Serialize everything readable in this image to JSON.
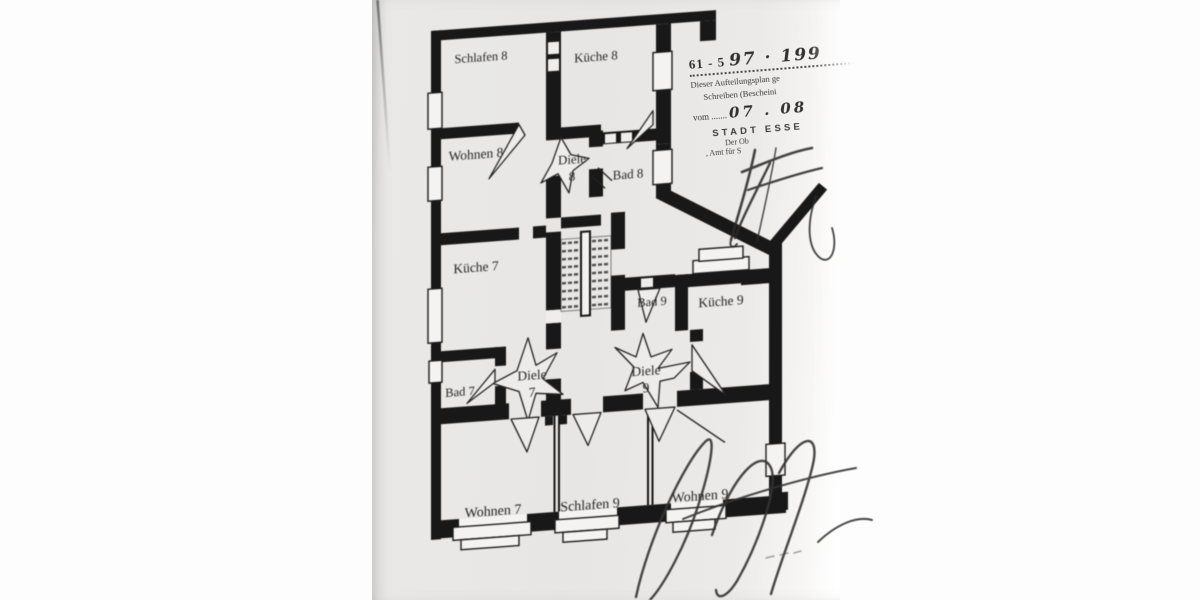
{
  "document": {
    "kind": "scanned floor plan (Aufteilungsplan)",
    "colors": {
      "paper": "#e8e7e5",
      "wall_ink": "#181818",
      "stamp_ink": "#3a3a3a",
      "margin": "#ffffff"
    }
  },
  "rooms": [
    {
      "id": "schlafen-8",
      "name": "Schlafen 8"
    },
    {
      "id": "kueche-8",
      "name": "Küche 8"
    },
    {
      "id": "wohnen-8",
      "name": "Wohnen 8"
    },
    {
      "id": "diele-8",
      "name": "Diele",
      "num": "8"
    },
    {
      "id": "bad-8",
      "name": "Bad 8"
    },
    {
      "id": "kueche-7",
      "name": "Küche 7"
    },
    {
      "id": "bad-9",
      "name": "Bad 9"
    },
    {
      "id": "kueche-9",
      "name": "Küche 9"
    },
    {
      "id": "diele-7",
      "name": "Diele",
      "num": "7"
    },
    {
      "id": "diele-9",
      "name": "Diele",
      "num": "9"
    },
    {
      "id": "bad-7",
      "name": "Bad 7"
    },
    {
      "id": "wohnen-7",
      "name": "Wohnen 7"
    },
    {
      "id": "schlafen-9",
      "name": "Schlafen 9"
    },
    {
      "id": "wohnen-9",
      "name": "Wohnen 9"
    }
  ],
  "stamp": {
    "file_prefix": "61 - 5",
    "file_hand": "97 · 199",
    "note_line1": "Dieser Aufteilungsplan ge",
    "note_line2": "Schreiben (Bescheini",
    "date_label": "vom .......",
    "date_hand": "07 . 08",
    "city": "STADT ESSE",
    "dept_line1": "Der Ob",
    "dept_line2": ", Amt für S"
  }
}
